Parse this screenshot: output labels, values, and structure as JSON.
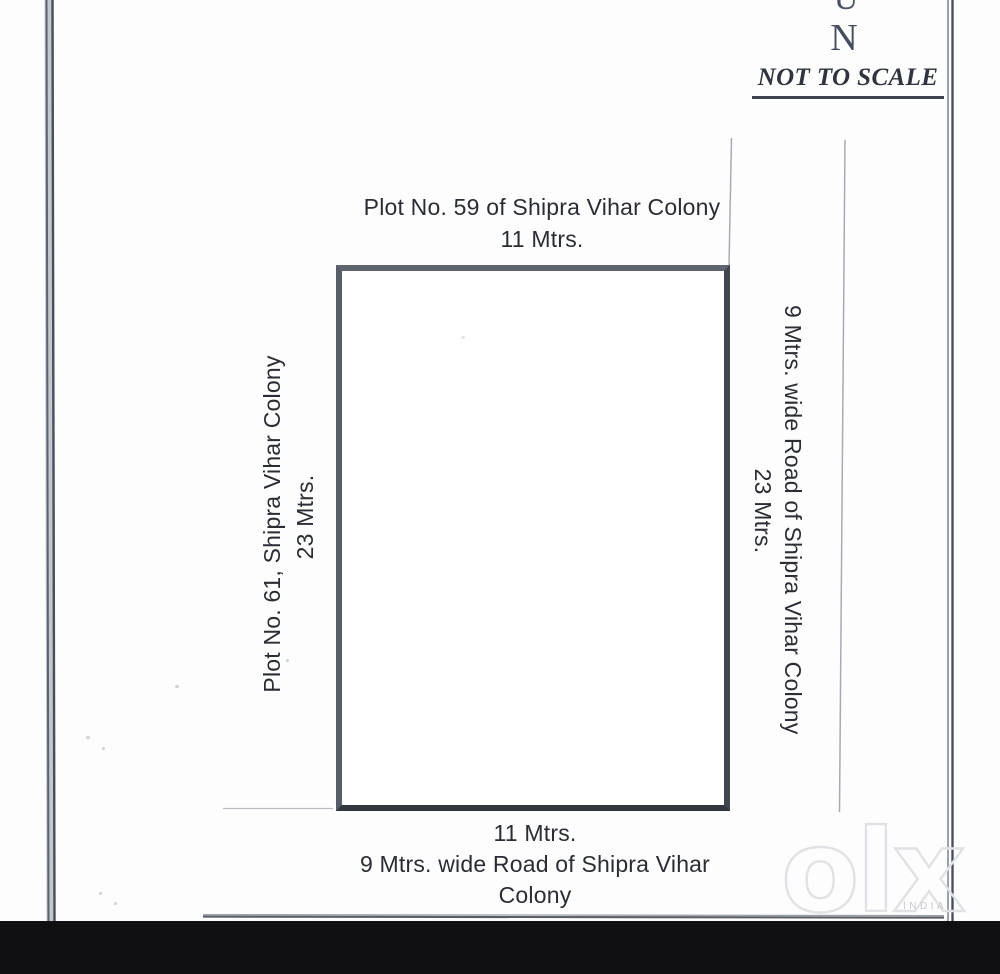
{
  "plan": {
    "north_marker_partial": "U",
    "north_marker": "N",
    "scale_note": "NOT TO SCALE",
    "north_side": {
      "label": "Plot No. 59 of Shipra Vihar Colony",
      "dimension": "11 Mtrs."
    },
    "west_side": {
      "label": "Plot No. 61, Shipra Vihar Colony",
      "dimension": "23 Mtrs."
    },
    "east_side": {
      "label": "9 Mtrs. wide Road of Shipra Vihar Colony",
      "dimension": "23 Mtrs."
    },
    "south_side": {
      "dimension": "11 Mtrs.",
      "label_lines": [
        "9 Mtrs. wide Road of Shipra Vihar",
        "Colony"
      ]
    }
  },
  "watermark": {
    "logo": "olx",
    "country": "INDIA"
  },
  "colors": {
    "plot_border": "#51565f",
    "text": "#2a2d33",
    "scan_line": "#a6abb3",
    "watermark_outline": "#e1e2e6",
    "footer_band": "#101013"
  }
}
